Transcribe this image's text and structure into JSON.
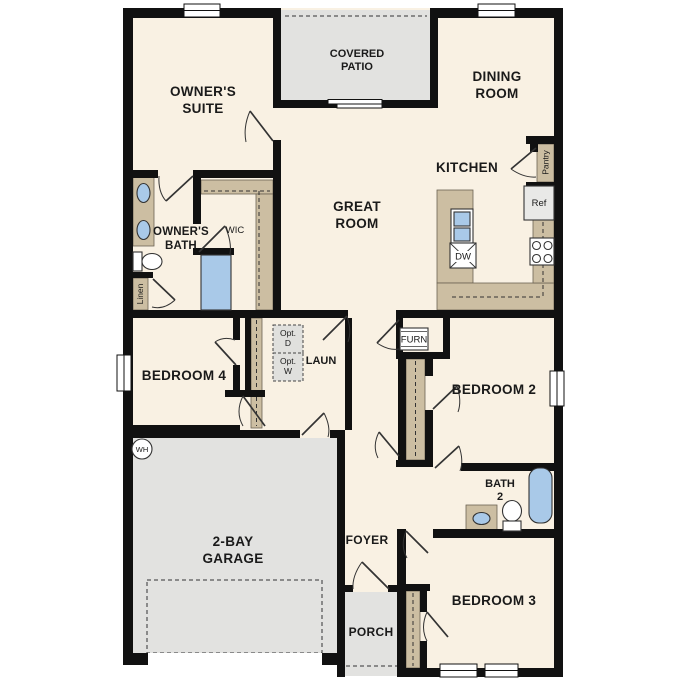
{
  "palette": {
    "wall": "#111111",
    "floor": "#f9f1e3",
    "outdoor": "#e2e2e0",
    "cabinet": "#ccbea2",
    "fixture_blue": "#a9c9e8",
    "appliance": "#e9e9e7",
    "line": "#333333"
  },
  "rooms": {
    "owners_suite": [
      "OWNER'S",
      "SUITE"
    ],
    "covered_patio": [
      "COVERED",
      "PATIO"
    ],
    "dining_room": [
      "DINING",
      "ROOM"
    ],
    "kitchen": "KITCHEN",
    "great_room": [
      "GREAT",
      "ROOM"
    ],
    "owners_bath": [
      "OWNER'S",
      "BATH"
    ],
    "wic": "WIC",
    "linen": "Linen",
    "pantry": "Pantry",
    "laundry": "LAUN",
    "bedroom_4": "BEDROOM 4",
    "bedroom_2": "BEDROOM 2",
    "bedroom_3": "BEDROOM 3",
    "bath_2": [
      "BATH",
      "2"
    ],
    "garage": [
      "2-BAY",
      "GARAGE"
    ],
    "foyer": "FOYER",
    "porch": "PORCH"
  },
  "fixtures": {
    "ref": "Ref",
    "dw": "DW",
    "furn": "FURN",
    "wh": "WH",
    "opt_dryer": [
      "Opt.",
      "D"
    ],
    "opt_washer": [
      "Opt.",
      "W"
    ]
  }
}
